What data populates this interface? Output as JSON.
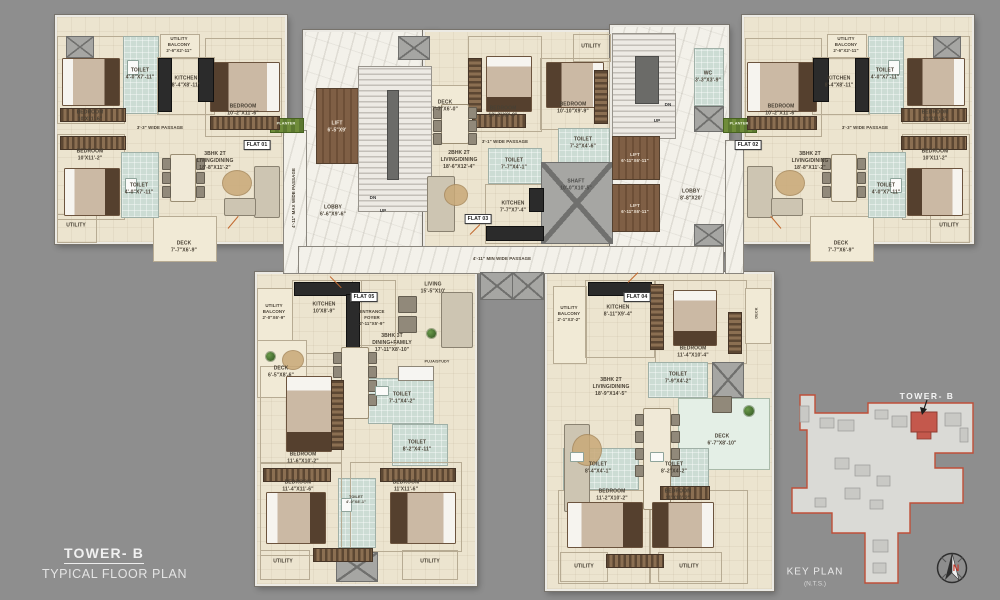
{
  "title": {
    "tower": "TOWER- B",
    "subtitle": "TYPICAL FLOOR PLAN"
  },
  "colors": {
    "accent_red": "#c0392b",
    "floor_cream": "#ece4cf",
    "wall_white": "#eceae4",
    "tile_blue": "#ccdcd4",
    "background_gray": "#8e8e8e"
  },
  "corridor": {
    "horizontal": "4'-11\" MIN WIDE PASSAGE",
    "vertical": "4'-11\" MAX WIDE PASSAGE"
  },
  "planter": "PLANTER",
  "core_left": {
    "lift": "LIFT\n6'-5\"X9'",
    "lobby": "LOBBY\n6'-6\"X9'-6\"",
    "dn": "DN",
    "up": "UP"
  },
  "core_right": {
    "lift1": "LIFT\n6'-11\"X6'-11\"",
    "lift2": "LIFT\n6'-11\"X6'-11\"",
    "lobby": "LOBBY\n8'-8\"X20'",
    "wc": "WC\n3'-3\"X3'-9\"",
    "shaft": "SHAFT\n10'-0\"X10'-5\"",
    "dn": "DN",
    "up": "UP"
  },
  "flat01": {
    "tag": "FLAT 01",
    "bedroom_tl": "BEDROOM\n10'X11'-6\"",
    "toilet_top": "TOILET\n4'-0\"X7'-11\"",
    "utility_balcony": "UTILITY\nBALCONY\n2'-6\"X2'-11\"",
    "kitchen": "KITCHEN\n8'-4\"X8'-11\"",
    "bedroom_tr": "BEDROOM\n10'-2\"X11'-6\"",
    "passage": "3'-3\" WIDE PASSAGE",
    "bedroom_bl": "BEDROOM\n10'X11'-2\"",
    "toilet_bottom": "TOILET\n4'-0\"X7'-11\"",
    "living": "3BHK 2T\nLIVING/DINING\n18'-8\"X11'-2\"",
    "utility": "UTILITY",
    "deck": "DECK\n7'-7\"X6'-9\""
  },
  "flat02": {
    "tag": "FLAT 02",
    "bedroom_tr": "BEDROOM\n10'X11'-6\"",
    "toilet_top": "TOILET\n4'-0\"X7'-11\"",
    "utility_balcony": "UTILITY\nBALCONY\n2'-6\"X2'-11\"",
    "kitchen": "KITCHEN\n8'-4\"X8'-11\"",
    "bedroom_tl": "BEDROOM\n10'-2\"X11'-6\"",
    "passage": "3'-3\" WIDE PASSAGE",
    "bedroom_br": "BEDROOM\n10'X11'-2\"",
    "toilet_bottom": "TOILET\n4'-0\"X7'-11\"",
    "living": "3BHK 2T\nLIVING/DINING\n18'-8\"X11'-2\"",
    "utility": "UTILITY",
    "deck": "DECK\n7'-7\"X6'-9\""
  },
  "flat03": {
    "tag": "FLAT 03",
    "deck": "DECK\n7'-7\"X6'-0\"",
    "bedroom_l": "BEDROOM\n10'-2\"X9'-9\"",
    "bedroom_r": "BEDROOM\n10'-10\"X9'-9\"",
    "utility": "UTILITY",
    "passage": "3'-1\" WIDE PASSAGE",
    "toilet_l": "TOILET\n7'-7\"X4'-1\"",
    "toilet_r": "TOILET\n7'-2\"X4'-6\"",
    "living": "2BHK 2T\nLIVING/DINING\n18'-6\"X12'-4\"",
    "kitchen": "KITCHEN\n7'-7\"X7'-4\""
  },
  "flat04": {
    "tag": "FLAT 04",
    "utility_balcony": "UTILITY\nBALCONY\n2'-1\"X3'-2\"",
    "kitchen": "KITCHEN\n8'-11\"X9'-4\"",
    "bedroom_top": "BEDROOM\n11'-4\"X10'-4\"",
    "deck_side": "DECK",
    "toilet_top": "TOILET\n7'-9\"X4'-2\"",
    "living": "3BHK 2T\nLIVING/DINING\n18'-9\"X14'-5\"",
    "deck": "DECK\n6'-7\"X8'-10\"",
    "toilet_left": "TOILET\n8'-4\"X4'-1\"",
    "toilet_right": "TOILET\n8'-2\"X4'-2\"",
    "bedroom_bl": "BEDROOM\n11'-2\"X10'-2\"",
    "bedroom_br": "BEDROOM\n11'X10'-2\"",
    "utility_a": "UTILITY",
    "utility_b": "UTILITY"
  },
  "flat05": {
    "tag": "FLAT 05",
    "utility_balcony": "UTILITY\nBALCONY\n2'-0\"X6'-9\"",
    "kitchen": "KITCHEN\n10'X8'-9\"",
    "entrance": "ENTRANCE\nFOYER\n2'-11\"X5'-9\"",
    "living": "LIVING\n15'-5\"X10'",
    "deck": "DECK\n6'-5\"X8'-6\"",
    "dining": "3BHK 3T\nDINING+FAMILY\n17'-11\"X8'-10\"",
    "puja": "PUJA/STUDY",
    "toilet_a": "TOILET\n7'-1\"X4'-2\"",
    "toilet_b": "TOILET\n8'-2\"X4'-11\"",
    "toilet_c": "TOILET\n4'-0\"X8'-1\"",
    "bedroom_1": "BEDROOM\n11'-6\"X10'-2\"",
    "bedroom_2": "BEDROOM\n11'-4\"X11'-6\"",
    "bedroom_3": "BEDROOM\n11'X11'-6\"",
    "utility_a": "UTILITY",
    "utility_b": "UTILITY"
  },
  "keyplan": {
    "tower": "TOWER- B",
    "caption": "KEY PLAN",
    "scale": "(N.T.S.)",
    "north": "N"
  }
}
